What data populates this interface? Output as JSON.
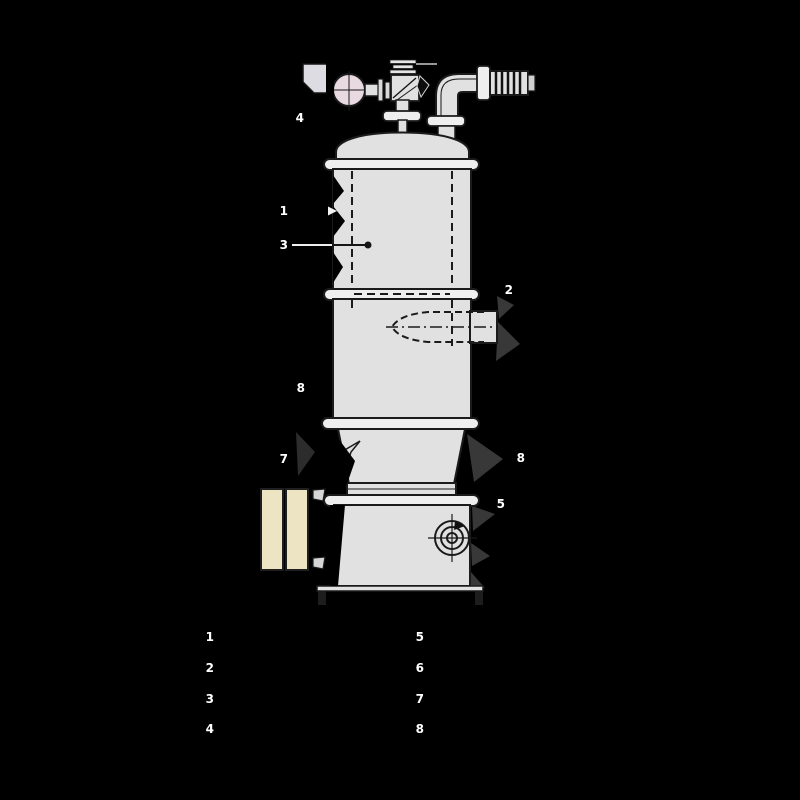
{
  "colors": {
    "background": "#000000",
    "body_fill": "#e1e1e1",
    "flange_fill": "#efefef",
    "outline": "#1b1b1b",
    "float_ball_fill": "#e9d9e1",
    "silencer_fill": "#ece4c3",
    "shadow_wedge": "#383838",
    "label_text": "#ffffff"
  },
  "callouts": {
    "c1": "1",
    "c2": "2",
    "c3": "3",
    "c4": "4",
    "c5": "5",
    "c7": "7",
    "c8_left": "8",
    "c8_right": "8"
  },
  "legend": {
    "left": [
      "1",
      "2",
      "3",
      "4"
    ],
    "right": [
      "5",
      "6",
      "7",
      "8"
    ]
  }
}
